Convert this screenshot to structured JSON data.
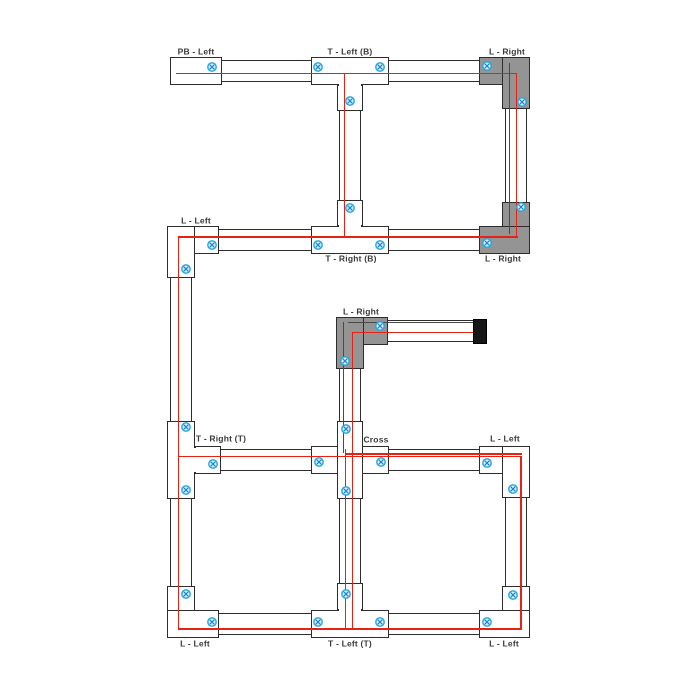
{
  "diagram": {
    "description": "Track lighting rail layout showing connector types",
    "canvas": {
      "width": 700,
      "height": 700,
      "background": "#ffffff"
    },
    "colors": {
      "track_fill": "#ffffff",
      "track_border": "#2d2d2d",
      "connector_gray": "#949494",
      "wire_red": "#e42313",
      "wire_dark": "#4a4a4a",
      "screw_stroke": "#22a7e0",
      "screw_fill": "#d6f0fb",
      "screw_cross": "#1f7fc4",
      "endcap_black": "#161616",
      "label_color": "#3a3a3a"
    },
    "labels": [
      {
        "text": "PB - Left",
        "x": 196,
        "y": 52
      },
      {
        "text": "T - Left (B)",
        "x": 350,
        "y": 52
      },
      {
        "text": "L - Right",
        "x": 507,
        "y": 52
      },
      {
        "text": "L - Left",
        "x": 196,
        "y": 221
      },
      {
        "text": "T - Right (B)",
        "x": 351,
        "y": 259
      },
      {
        "text": "L - Right",
        "x": 503,
        "y": 259
      },
      {
        "text": "L - Right",
        "x": 361,
        "y": 312
      },
      {
        "text": "T - Right (T)",
        "x": 221,
        "y": 439
      },
      {
        "text": "Cross",
        "x": 376,
        "y": 440
      },
      {
        "text": "L - Left",
        "x": 505,
        "y": 439
      },
      {
        "text": "L - Left",
        "x": 195,
        "y": 644
      },
      {
        "text": "T - Left (T)",
        "x": 350,
        "y": 644
      },
      {
        "text": "L - Left",
        "x": 504,
        "y": 644
      }
    ],
    "tracks": [
      [
        170,
        60,
        360,
        22
      ],
      [
        167,
        229,
        363,
        22
      ],
      [
        339,
        60,
        22,
        191
      ],
      [
        505,
        60,
        22,
        191
      ],
      [
        170,
        229,
        22,
        406
      ],
      [
        170,
        449,
        360,
        22
      ],
      [
        167,
        613,
        363,
        22
      ],
      [
        339,
        449,
        22,
        186
      ],
      [
        505,
        449,
        22,
        186
      ],
      [
        339,
        320,
        135,
        22
      ],
      [
        339,
        320,
        22,
        140
      ]
    ],
    "pieces": [
      [
        170,
        57,
        52,
        28,
        "w",
        1
      ],
      [
        311,
        57,
        78,
        28,
        "w",
        1
      ],
      [
        337,
        85,
        26,
        26,
        "w",
        1
      ],
      [
        339,
        80,
        22,
        9,
        "w",
        0
      ],
      [
        479,
        57,
        51,
        28,
        "g",
        1
      ],
      [
        502,
        57,
        28,
        52,
        "g",
        1
      ],
      [
        504,
        59,
        24,
        24,
        "g",
        0
      ],
      [
        502,
        202,
        28,
        52,
        "g",
        1
      ],
      [
        479,
        226,
        51,
        28,
        "g",
        1
      ],
      [
        504,
        228,
        24,
        24,
        "g",
        0
      ],
      [
        167,
        226,
        52,
        28,
        "w",
        1
      ],
      [
        167,
        226,
        28,
        52,
        "w",
        1
      ],
      [
        169,
        228,
        24,
        24,
        "w",
        0
      ],
      [
        311,
        226,
        78,
        28,
        "w",
        1
      ],
      [
        337,
        200,
        26,
        26,
        "w",
        1
      ],
      [
        339,
        222,
        22,
        9,
        "w",
        0
      ],
      [
        336,
        317,
        52,
        28,
        "g",
        1
      ],
      [
        336,
        317,
        28,
        52,
        "g",
        1
      ],
      [
        338,
        319,
        24,
        24,
        "g",
        0
      ],
      [
        167,
        421,
        28,
        78,
        "w",
        1
      ],
      [
        195,
        446,
        26,
        28,
        "w",
        1
      ],
      [
        190,
        448,
        10,
        24,
        "w",
        0
      ],
      [
        311,
        446,
        78,
        28,
        "w",
        1
      ],
      [
        337,
        421,
        26,
        78,
        "w",
        1
      ],
      [
        339,
        448,
        22,
        24,
        "w",
        0
      ],
      [
        479,
        446,
        51,
        28,
        "w",
        1
      ],
      [
        502,
        446,
        28,
        52,
        "w",
        1
      ],
      [
        504,
        448,
        24,
        24,
        "w",
        0
      ],
      [
        167,
        586,
        28,
        52,
        "w",
        1
      ],
      [
        167,
        610,
        52,
        28,
        "w",
        1
      ],
      [
        169,
        612,
        24,
        24,
        "w",
        0
      ],
      [
        311,
        610,
        78,
        28,
        "w",
        1
      ],
      [
        337,
        583,
        26,
        27,
        "w",
        1
      ],
      [
        339,
        606,
        22,
        9,
        "w",
        0
      ],
      [
        502,
        586,
        28,
        52,
        "w",
        1
      ],
      [
        479,
        610,
        51,
        28,
        "w",
        1
      ],
      [
        504,
        612,
        24,
        24,
        "w",
        0
      ]
    ],
    "wires_red": [
      [
        176,
        72.5,
        341,
        1.7
      ],
      [
        515.8,
        72.5,
        1.7,
        165.5
      ],
      [
        179,
        236,
        338.5,
        1.7
      ],
      [
        343.8,
        72.5,
        1.7,
        165.2
      ],
      [
        177.8,
        236,
        1.7,
        393.5
      ],
      [
        177.8,
        455.8,
        344,
        1.7
      ],
      [
        345,
        453.3,
        176.5,
        1.5
      ],
      [
        520.1,
        455.8,
        1.7,
        173.9
      ],
      [
        177.8,
        628,
        344,
        1.7
      ],
      [
        344.8,
        449,
        1.7,
        180.7
      ],
      [
        351.8,
        331.8,
        1.7,
        297.9
      ],
      [
        351.8,
        331.8,
        127.2,
        1.7
      ]
    ],
    "wires_dark": [
      [
        508.8,
        63,
        1.3,
        171
      ],
      [
        348,
        321.8,
        130,
        1.3
      ],
      [
        342.6,
        321.8,
        1.3,
        131
      ]
    ],
    "screws": [
      [
        212,
        67
      ],
      [
        318,
        67
      ],
      [
        380,
        67
      ],
      [
        487,
        66
      ],
      [
        350,
        101
      ],
      [
        522,
        102
      ],
      [
        350,
        208
      ],
      [
        521,
        207
      ],
      [
        212,
        245
      ],
      [
        318,
        245
      ],
      [
        380,
        245
      ],
      [
        487,
        243
      ],
      [
        186,
        269
      ],
      [
        380,
        326
      ],
      [
        345,
        361
      ],
      [
        186,
        427
      ],
      [
        346,
        429
      ],
      [
        319,
        462
      ],
      [
        381,
        462
      ],
      [
        213,
        464
      ],
      [
        487,
        463
      ],
      [
        186,
        490
      ],
      [
        346,
        491
      ],
      [
        513,
        489
      ],
      [
        186,
        594
      ],
      [
        346,
        594
      ],
      [
        513,
        595
      ],
      [
        212,
        622
      ],
      [
        318,
        622
      ],
      [
        380,
        622
      ],
      [
        487,
        622
      ]
    ],
    "endcap": [
      473,
      319,
      14,
      25
    ]
  }
}
